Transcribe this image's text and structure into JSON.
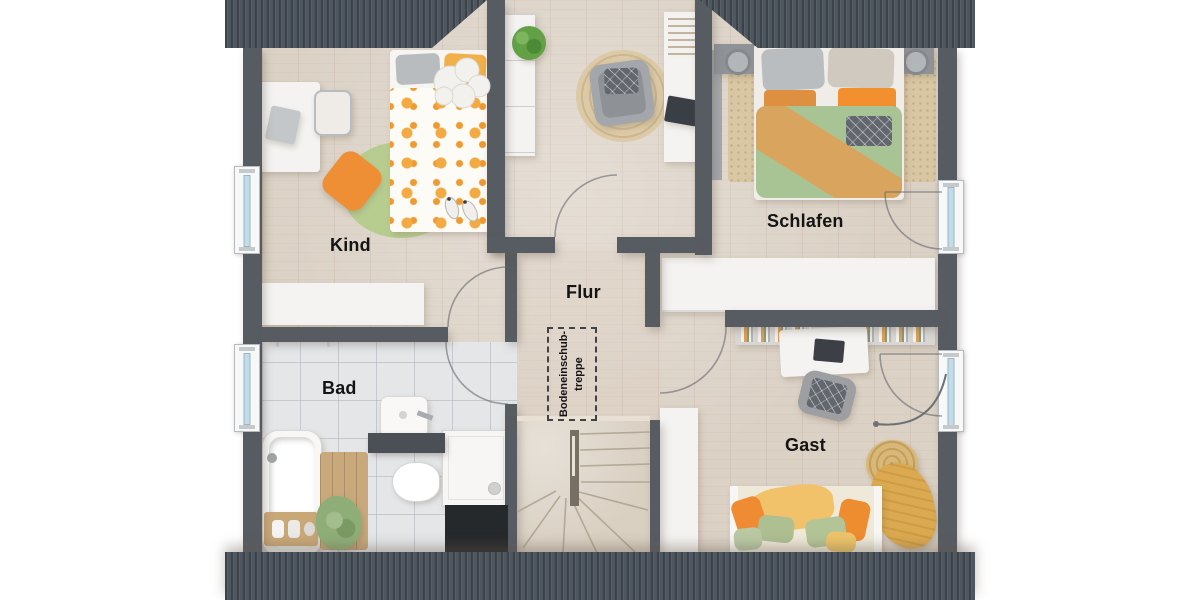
{
  "rooms": {
    "kind": {
      "label": "Kind"
    },
    "schlafen": {
      "label": "Schlafen"
    },
    "flur": {
      "label": "Flur"
    },
    "bad": {
      "label": "Bad"
    },
    "gast": {
      "label": "Gast"
    }
  },
  "annotations": {
    "attic_stairs": {
      "line1": "Bodeneinschub-",
      "line2": "treppe"
    }
  },
  "colors": {
    "roof": "#4e575f",
    "wall": "#575c63",
    "floor_wood": "#dbd1c5",
    "floor_tile": "#e4e6e8",
    "window_glass": "#c2dcec",
    "accent_orange": "#ef8f35",
    "accent_green": "#aec592",
    "accent_ochre": "#d9a55e"
  }
}
